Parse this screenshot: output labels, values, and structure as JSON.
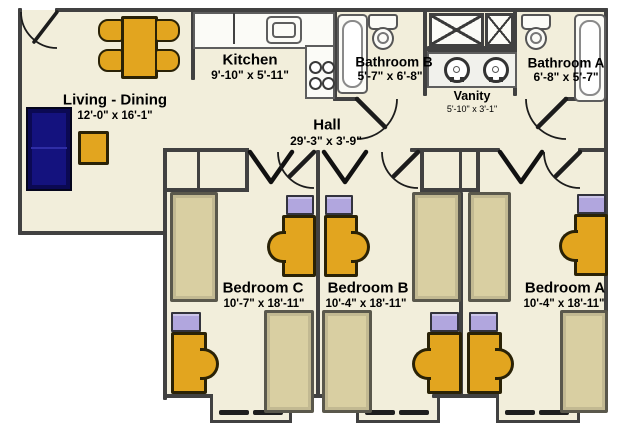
{
  "title": "Three-bedroom apartment floor plan",
  "colors": {
    "background": "#FFFFFF",
    "floor": "#F2EEDB",
    "wall": "#414141",
    "furniture_gold": "#E2A51F",
    "sofa_navy": "#14127E",
    "bed_tan": "#D9CFA2",
    "dresser_lavender": "#B1A6DE",
    "fixture_white": "#FBFBF7"
  },
  "rooms": {
    "living_dining": {
      "label": "Living - Dining",
      "dims": "12'-0\" x 16'-1\""
    },
    "kitchen": {
      "label": "Kitchen",
      "dims": "9'-10\" x 5'-11\""
    },
    "bathroom_b": {
      "label": "Bathroom B",
      "dims": "5'-7\" x 6'-8\""
    },
    "vanity": {
      "label": "Vanity",
      "dims": "5'-10\" x 3'-1\""
    },
    "bathroom_a": {
      "label": "Bathroom A",
      "dims": "6'-8\" x 5'-7\""
    },
    "hall": {
      "label": "Hall",
      "dims": "29'-3\" x 3'-9\""
    },
    "bedroom_c": {
      "label": "Bedroom C",
      "dims": "10'-7\" x 18'-11\""
    },
    "bedroom_b": {
      "label": "Bedroom B",
      "dims": "10'-4\" x 18'-11\""
    },
    "bedroom_a": {
      "label": "Bedroom A",
      "dims": "10'-4\" x 18'-11\""
    }
  },
  "furniture": {
    "living_dining": [
      "dining-table",
      "dining-chair",
      "dining-chair",
      "dining-chair",
      "dining-chair",
      "sofa",
      "side-table"
    ],
    "kitchen": [
      "counter",
      "kitchen-sink",
      "stove"
    ],
    "bathroom_b": [
      "bathtub",
      "toilet"
    ],
    "vanity_area": [
      "shower",
      "double-sink-vanity"
    ],
    "bathroom_a": [
      "toilet",
      "bathtub"
    ],
    "bedroom_c": [
      "closet",
      "bed",
      "bed",
      "desk",
      "desk",
      "desk-chair",
      "desk-chair",
      "dresser",
      "dresser"
    ],
    "bedroom_b": [
      "closet",
      "bed",
      "bed",
      "desk",
      "desk",
      "desk-chair",
      "desk-chair",
      "dresser",
      "dresser"
    ],
    "bedroom_a": [
      "closet",
      "bed",
      "bed",
      "desk",
      "desk",
      "desk-chair",
      "desk-chair",
      "dresser",
      "dresser"
    ],
    "windows": 3,
    "doors": [
      "entry-door",
      "bathroom-b-door",
      "bathroom-a-door",
      "bedroom-c-door",
      "bedroom-b-door",
      "bedroom-a-door"
    ]
  }
}
